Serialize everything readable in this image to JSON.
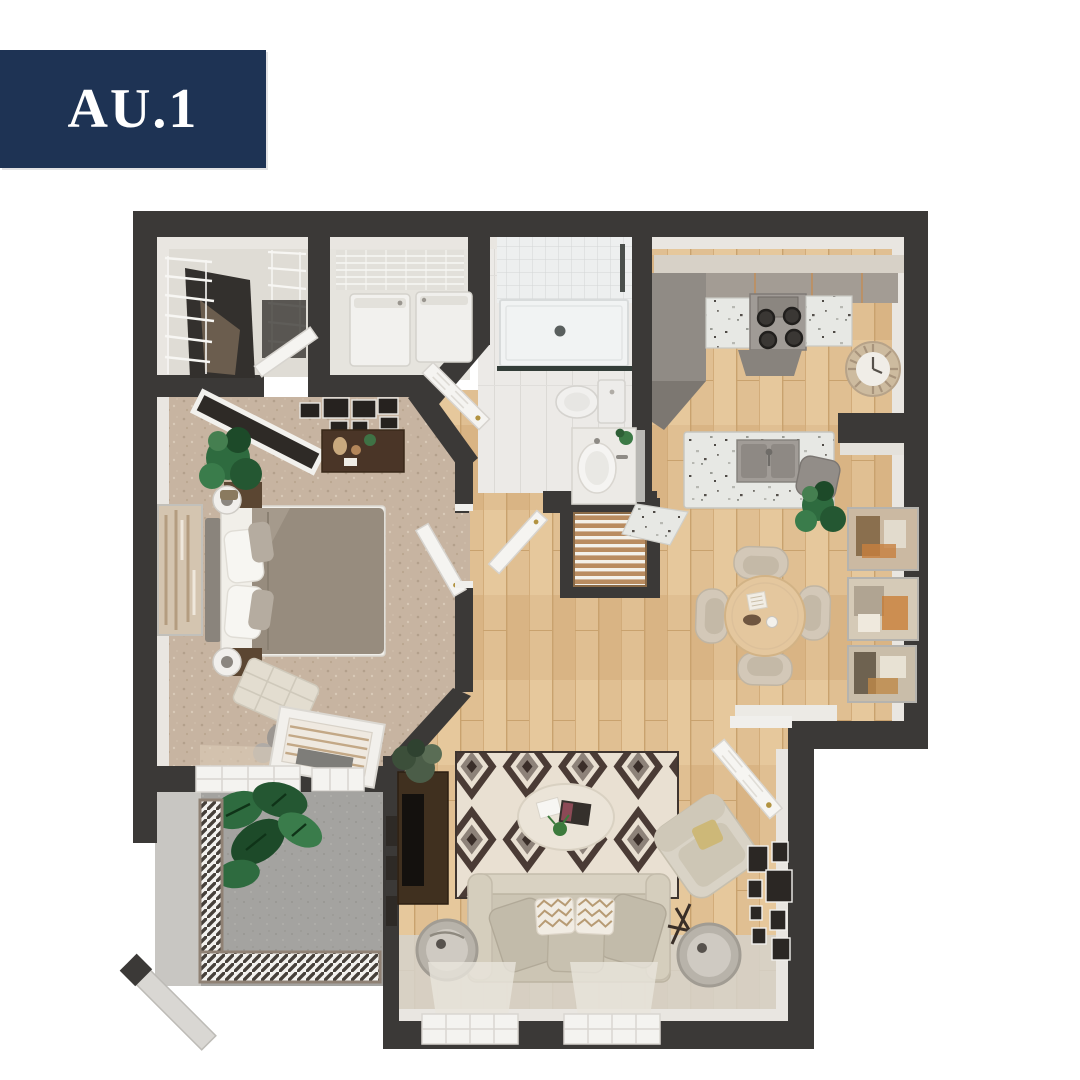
{
  "page": {
    "background": "#ffffff"
  },
  "badge": {
    "label": "AU.1"
  },
  "colors": {
    "accent_navy": "#1e3354",
    "badge_text": "#ffffff",
    "wall_dark": "#3b3937",
    "wall_face": "#e9e6e1",
    "wood_floor": "#e0bf92",
    "carpet_tan": "#c7b4a1",
    "bathroom_tile": "#eceae7",
    "patio_concrete": "#a4a3a0",
    "granite_speckle": "#e7e8e4",
    "rug_cream": "#e9e0d2",
    "rug_brown": "#4a3b35",
    "sofa_beige": "#ccc5b4",
    "bed_taupe": "#978c7e",
    "table_wood": "#e4c79e",
    "plant_green": "#2e6b3f",
    "door_white": "#f5f4f1"
  },
  "floorplan": {
    "style": "3d-top-down-apartment-render",
    "rooms": [
      {
        "id": "walk-in-closet",
        "features": [
          "wire-shelving",
          "hanging-clothes",
          "closet-door"
        ]
      },
      {
        "id": "laundry-room",
        "features": [
          "washer",
          "dryer",
          "wire-shelf",
          "laundry-door"
        ]
      },
      {
        "id": "bathroom",
        "features": [
          "shower",
          "glass-door",
          "toilet",
          "vanity-sink",
          "mirror"
        ]
      },
      {
        "id": "kitchen",
        "features": [
          "upper-cabinets",
          "stove-4-burners",
          "granite-counters",
          "island-double-sink",
          "wall-clock"
        ]
      },
      {
        "id": "dining-area",
        "features": [
          "round-table",
          "four-chairs",
          "wall-art-x3",
          "corner-plant"
        ]
      },
      {
        "id": "bedroom",
        "features": [
          "bed",
          "headboard",
          "nightstands-lamps",
          "dresser",
          "gallery-frames",
          "leaning-mirror",
          "bench",
          "plant",
          "windows"
        ]
      },
      {
        "id": "hallway",
        "features": [
          "linen-closet-louvered",
          "interior-doors"
        ]
      },
      {
        "id": "living-room",
        "features": [
          "geometric-rug",
          "oval-coffee-table",
          "sofa-chevron-pillows",
          "drum-side-tables",
          "armchair",
          "tv-console",
          "gallery-wall",
          "windows"
        ]
      },
      {
        "id": "patio",
        "features": [
          "concrete-floor",
          "railing",
          "monstera-plant",
          "privacy-wall"
        ]
      },
      {
        "id": "entry",
        "features": [
          "front-door",
          "threshold"
        ]
      }
    ]
  }
}
